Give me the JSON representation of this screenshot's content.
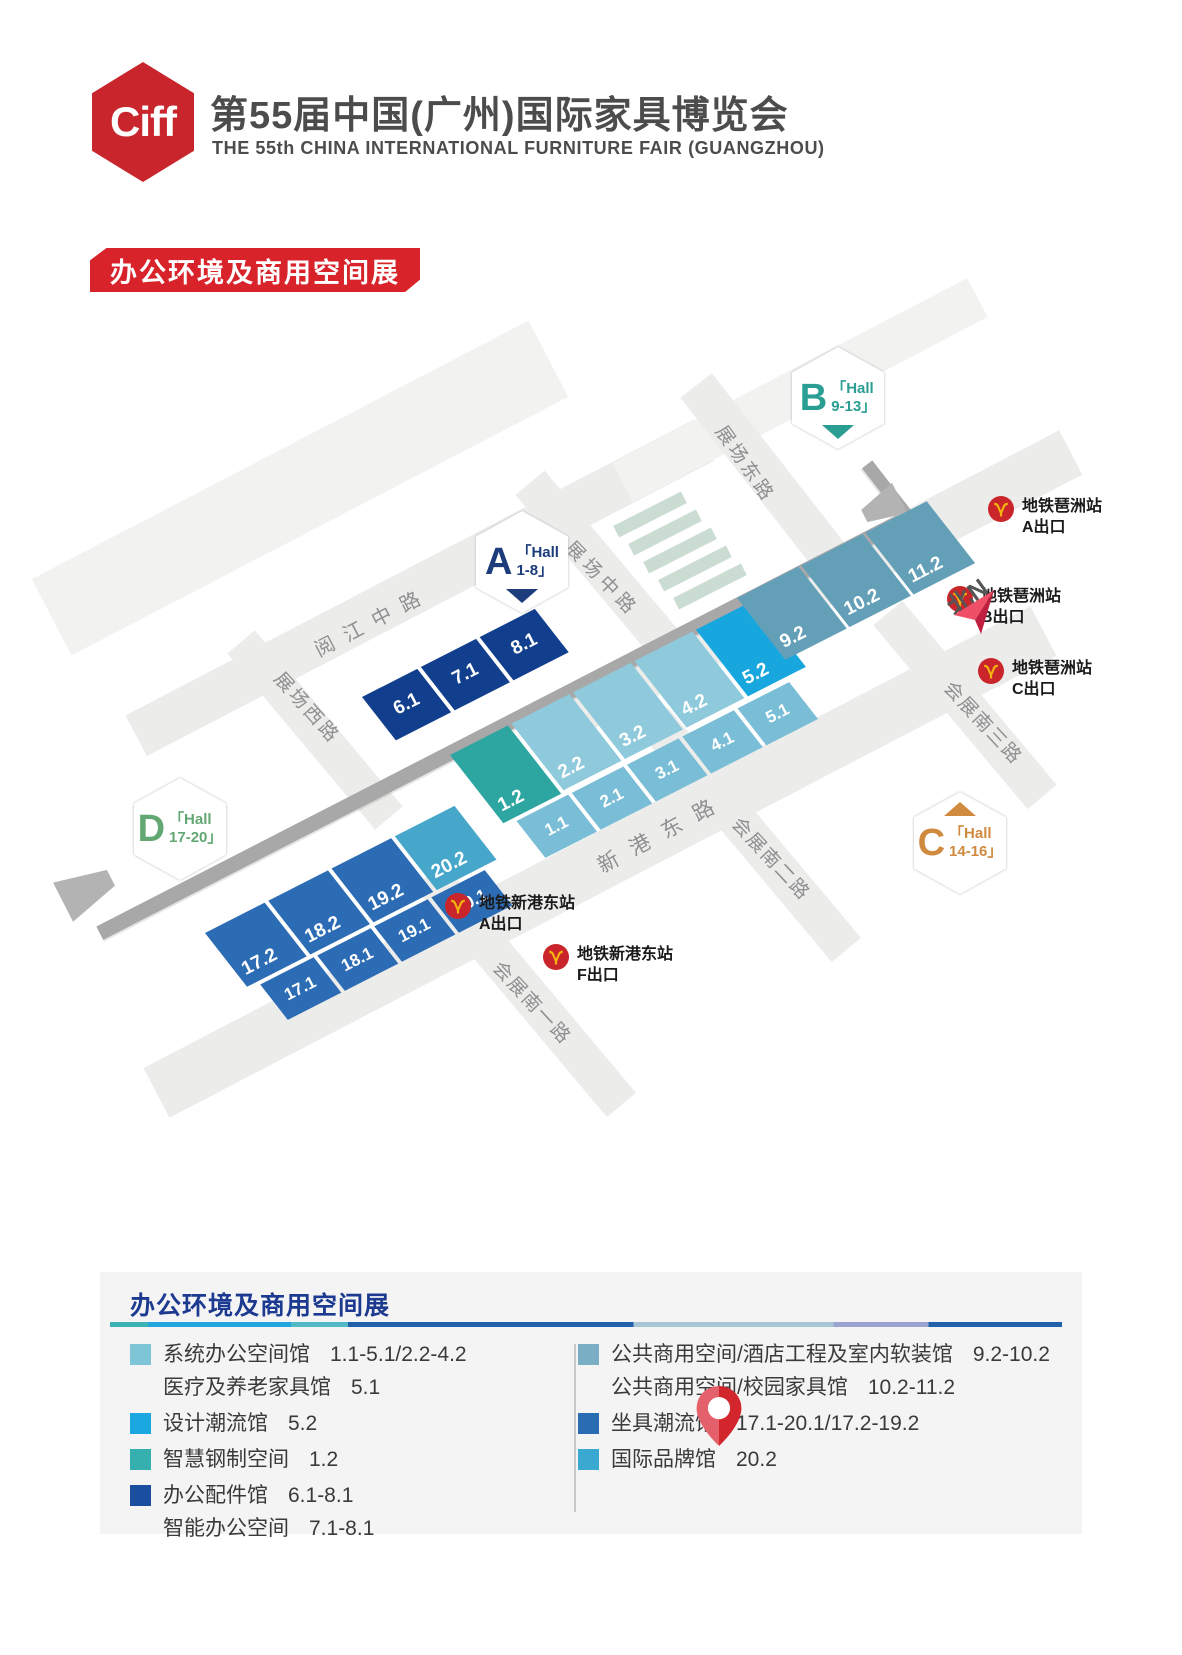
{
  "header": {
    "logo": "Ciff",
    "title_cn": "第55届中国(广州)国际家具博览会",
    "title_en": "THE 55th CHINA INTERNATIONAL FURNITURE FAIR (GUANGZHOU)"
  },
  "badge": "办公环境及商用空间展",
  "map": {
    "north": "北N",
    "hall_markers": [
      {
        "letter": "A",
        "hall": "「Hall",
        "range": "1-8」"
      },
      {
        "letter": "B",
        "hall": "「Hall",
        "range": "9-13」"
      },
      {
        "letter": "C",
        "hall": "「Hall",
        "range": "14-16」"
      },
      {
        "letter": "D",
        "hall": "「Hall",
        "range": "17-20」"
      }
    ],
    "roads": [
      {
        "name": "阅江中路"
      },
      {
        "name": "展场东路"
      },
      {
        "name": "展场中路"
      },
      {
        "name": "展场西路"
      },
      {
        "name": "新港东路"
      },
      {
        "name": "会展南三路"
      },
      {
        "name": "会展南二路"
      },
      {
        "name": "会展南一路"
      }
    ],
    "metro": [
      {
        "station": "地铁琶洲站",
        "exit": "A出口"
      },
      {
        "station": "地铁琶洲站",
        "exit": "B出口"
      },
      {
        "station": "地铁琶洲站",
        "exit": "C出口"
      },
      {
        "station": "地铁新港东站",
        "exit": "A出口"
      },
      {
        "station": "地铁新港东站",
        "exit": "F出口"
      }
    ],
    "halls": {
      "groupA": [
        "6.1",
        "7.1",
        "8.1"
      ],
      "main_top": [
        "1.2",
        "2.2",
        "3.2",
        "4.2",
        "5.2"
      ],
      "main_bottom": [
        "1.1",
        "2.1",
        "3.1",
        "4.1",
        "5.1"
      ],
      "groupB": [
        "9.2",
        "10.2",
        "11.2"
      ],
      "groupD_top": [
        "17.2",
        "18.2",
        "19.2",
        "20.2"
      ],
      "groupD_bottom": [
        "17.1",
        "18.1",
        "19.1",
        "20.1"
      ]
    }
  },
  "event": {
    "date": "2025年3月28-31日",
    "venue": "广州琶洲·广交会展馆"
  },
  "legend": {
    "title": "办公环境及商用空间展",
    "left": [
      {
        "color": "#7ec5d8",
        "lines": [
          {
            "label": "系统办公空间馆",
            "range": "1.1-5.1/2.2-4.2"
          },
          {
            "label": "医疗及养老家具馆",
            "range": "5.1"
          }
        ]
      },
      {
        "color": "#1ba7e0",
        "lines": [
          {
            "label": "设计潮流馆",
            "range": "5.2"
          }
        ]
      },
      {
        "color": "#35b0af",
        "lines": [
          {
            "label": "智慧钢制空间",
            "range": "1.2"
          }
        ]
      },
      {
        "color": "#1a4fa0",
        "lines": [
          {
            "label": "办公配件馆",
            "range": "6.1-8.1"
          },
          {
            "label": "智能办公空间",
            "range": "7.1-8.1"
          }
        ]
      }
    ],
    "right": [
      {
        "color": "#7aaec4",
        "lines": [
          {
            "label": "公共商用空间/酒店工程及室内软装馆",
            "range": "9.2-10.2"
          },
          {
            "label": "公共商用空间/校园家具馆",
            "range": "10.2-11.2"
          }
        ]
      },
      {
        "color": "#2a6cb4",
        "lines": [
          {
            "label": "坐具潮流馆",
            "range": "17.1-20.1/17.2-19.2"
          }
        ]
      },
      {
        "color": "#3aa9d2",
        "lines": [
          {
            "label": "国际品牌馆",
            "range": "20.2"
          }
        ]
      }
    ]
  },
  "colors": {
    "brand_red": "#c9252c",
    "badge_red": "#d8232a",
    "hall_navy": "#123f8d",
    "hall_light_blue": "#79bed6",
    "hall_teal": "#2da6a2",
    "hall_bright_blue": "#18a6df",
    "hall_steel_blue": "#649fb8",
    "hall_mid_blue": "#2c6cb4",
    "hall_cyan": "#47a7cb",
    "legend_title_blue": "#1c3a90",
    "metro_red": "#c9252b",
    "metro_yellow": "#f5b40d"
  }
}
